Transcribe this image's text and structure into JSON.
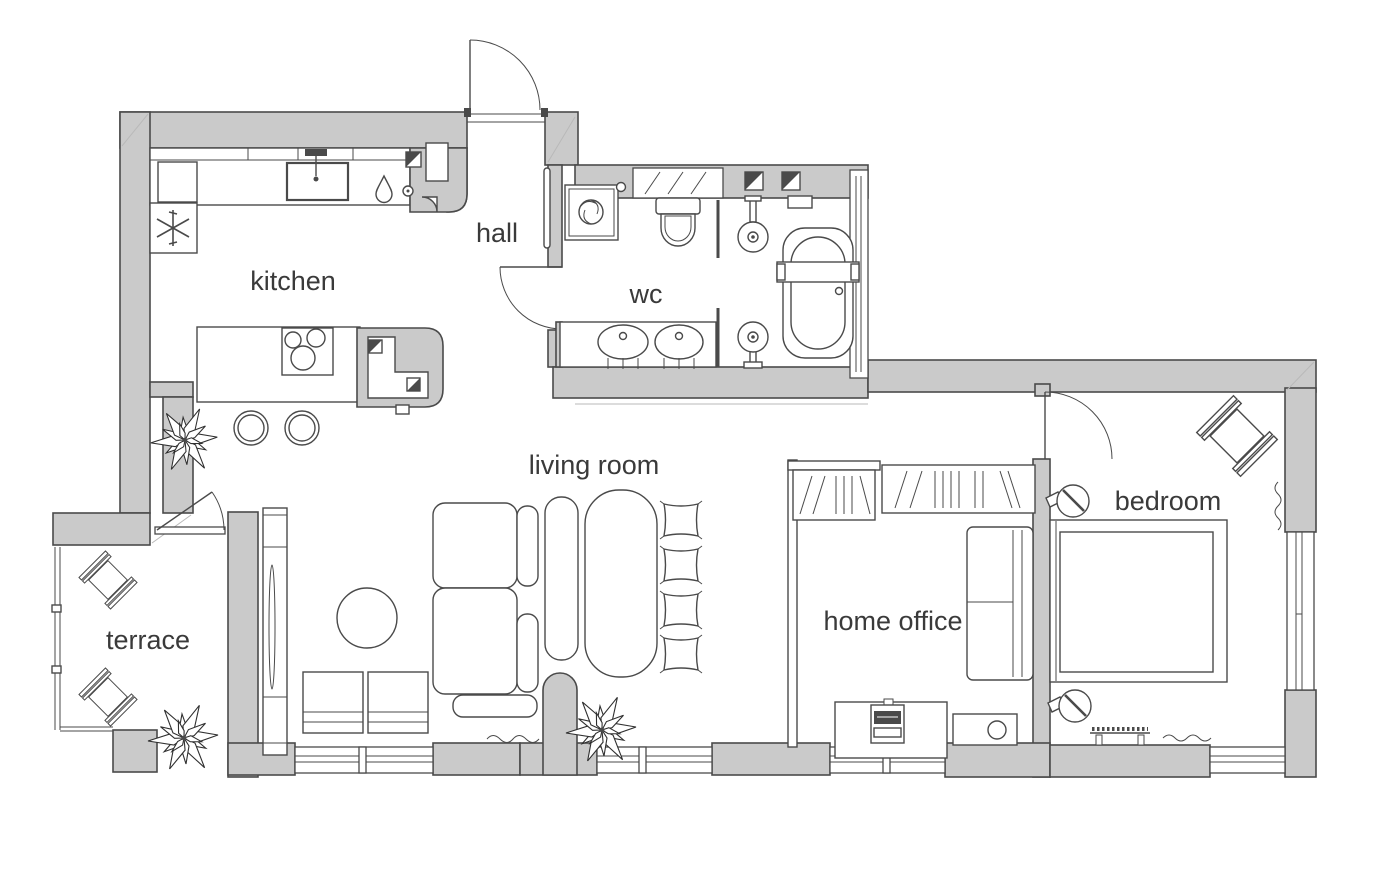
{
  "floor_plan": {
    "rooms": [
      {
        "id": "kitchen",
        "label": "kitchen"
      },
      {
        "id": "hall",
        "label": "hall"
      },
      {
        "id": "wc",
        "label": "wc"
      },
      {
        "id": "living-room",
        "label": "living room"
      },
      {
        "id": "terrace",
        "label": "terrace"
      },
      {
        "id": "home-office",
        "label": "home office"
      },
      {
        "id": "bedroom",
        "label": "bedroom"
      }
    ],
    "colors": {
      "wall": "#cacaca",
      "line": "#4a4a4a",
      "text": "#3a3a3a",
      "background": "#ffffff"
    },
    "fixtures": {
      "kitchen": [
        "fridge-freezer-icon",
        "kitchen-sink-icon",
        "hob-icon",
        "island-counter",
        "bar-stools",
        "plant-icon"
      ],
      "hall": [
        "entry-door-icon",
        "mirror-icon"
      ],
      "wc": [
        "washing-machine-icon",
        "toilet-icon",
        "double-basin",
        "shower-icon",
        "bathtub-icon"
      ],
      "living_room": [
        "corner-sofa",
        "coffee-table",
        "tv-unit",
        "dining-table",
        "bench",
        "floor-cushions",
        "poufs",
        "plant-icon"
      ],
      "terrace": [
        "lounge-chairs",
        "plant-icon",
        "railing"
      ],
      "home_office": [
        "wardrobe",
        "desk",
        "laptop-icon",
        "office-sofa",
        "cabinet"
      ],
      "bedroom": [
        "double-bed",
        "wall-lamp-icon",
        "armchair",
        "bedroom-bench",
        "curtain-squiggle"
      ]
    }
  }
}
